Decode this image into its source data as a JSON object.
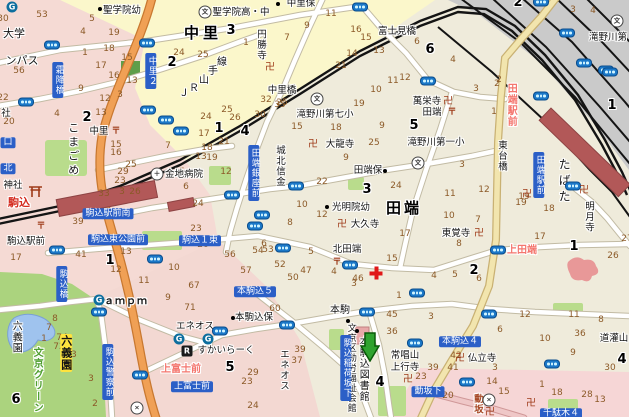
{
  "map_title": "駒込・田端周辺地図",
  "colors": {
    "badge_blue": "#2B5FC7",
    "road_orange": "#F0A055",
    "road_yellow": "#F2E5AE",
    "rail_black": "#111111",
    "station_red": "#B25858",
    "park_green": "#ABD37E",
    "pond_blue": "#9FC3EE",
    "block_yellow": "#FBF7CB",
    "block_pink": "#F5DAD4",
    "block_beige": "#EFEBDB",
    "yard_gray": "#CACACA",
    "lot_number_brown": "#8C5A28",
    "marker_green": "#2FA32F",
    "intersection_pink": "#F4766E"
  },
  "marker": {
    "x": 360,
    "y": 332,
    "points_to": "本駒込図書館"
  },
  "labels": [
    {
      "t": "聖学院幼",
      "x": 122,
      "y": 11
    },
    {
      "t": "中里保",
      "x": 301,
      "y": 4
    },
    {
      "t": "聖学院高・中",
      "x": 241,
      "y": 13
    },
    {
      "t": "中里",
      "x": 203,
      "y": 34,
      "s": "big",
      "fs": 15,
      "ls": 4
    },
    {
      "t": "円勝寺",
      "x": 260,
      "y": 45,
      "v": 1
    },
    {
      "t": "富士見橋",
      "x": 397,
      "y": 32
    },
    {
      "t": "中里橋",
      "x": 282,
      "y": 91
    },
    {
      "t": "Ｊ",
      "x": 184,
      "y": 94,
      "fs": 10
    },
    {
      "t": "Ｒ",
      "x": 194,
      "y": 89,
      "fs": 10
    },
    {
      "t": "山",
      "x": 204,
      "y": 81,
      "fs": 10
    },
    {
      "t": "手",
      "x": 213,
      "y": 72,
      "fs": 10
    },
    {
      "t": "線",
      "x": 222,
      "y": 63,
      "fs": 10
    },
    {
      "t": "こまごめ",
      "x": 73,
      "y": 150,
      "v": 1,
      "fs": 11,
      "ls": 3
    },
    {
      "t": "中里",
      "x": 99,
      "y": 132
    },
    {
      "t": "金地病院",
      "x": 184,
      "y": 175
    },
    {
      "t": "駒込",
      "x": 19,
      "y": 203,
      "s": "red"
    },
    {
      "t": "駒込駅前",
      "x": 26,
      "y": 242
    },
    {
      "t": "城北信金",
      "x": 279,
      "y": 166,
      "v": 1
    },
    {
      "t": "滝野川第七小",
      "x": 325,
      "y": 115
    },
    {
      "t": "大龍寺",
      "x": 340,
      "y": 145
    },
    {
      "t": "田端保",
      "x": 368,
      "y": 171
    },
    {
      "t": "光明院幼",
      "x": 351,
      "y": 208
    },
    {
      "t": "大久寺",
      "x": 365,
      "y": 225
    },
    {
      "t": "北田端",
      "x": 347,
      "y": 250
    },
    {
      "t": "田端",
      "x": 404,
      "y": 209,
      "s": "big",
      "fs": 15,
      "ls": 3
    },
    {
      "t": "萬栄寺",
      "x": 427,
      "y": 102
    },
    {
      "t": "田端",
      "x": 432,
      "y": 113
    },
    {
      "t": "滝野川第一小",
      "x": 436,
      "y": 143
    },
    {
      "t": "滝野川第",
      "x": 608,
      "y": 38
    },
    {
      "t": "東台橋",
      "x": 501,
      "y": 156,
      "v": 1
    },
    {
      "t": "東覚寺",
      "x": 456,
      "y": 234
    },
    {
      "t": "明月寺",
      "x": 588,
      "y": 217,
      "v": 1
    },
    {
      "t": "上田端",
      "x": 522,
      "y": 251,
      "s": "pink"
    },
    {
      "t": "田端駅前",
      "x": 510,
      "y": 105,
      "s": "pink",
      "v": 1
    },
    {
      "t": "たばた",
      "x": 564,
      "y": 182,
      "v": 1,
      "fs": 12,
      "ls": 4
    },
    {
      "t": "仏立寺",
      "x": 482,
      "y": 359
    },
    {
      "t": "道灌山",
      "x": 614,
      "y": 339
    },
    {
      "t": "常唱山",
      "x": 405,
      "y": 356
    },
    {
      "t": "上行寺",
      "x": 405,
      "y": 368
    },
    {
      "t": "エネオス",
      "x": 195,
      "y": 327
    },
    {
      "t": "エネオス",
      "x": 283,
      "y": 370,
      "v": 1
    },
    {
      "t": "すかいらーく",
      "x": 226,
      "y": 351
    },
    {
      "t": "ａｍｐｍ",
      "x": 126,
      "y": 302,
      "s": "store",
      "fs": 10
    },
    {
      "t": "本駒込保",
      "x": 254,
      "y": 318
    },
    {
      "t": "文京区勤労福祉会館",
      "x": 350,
      "y": 368,
      "v": 1,
      "fs": 9
    },
    {
      "t": "本駒込図書館",
      "x": 362,
      "y": 369,
      "v": 1,
      "fs": 10
    },
    {
      "t": "本駒",
      "x": 340,
      "y": 311,
      "fs": 10
    },
    {
      "t": "六義園",
      "x": 15,
      "y": 337,
      "v": 1,
      "fs": 10
    },
    {
      "t": "六義園",
      "x": 66,
      "y": 353,
      "v": 1,
      "s": "hl",
      "fs": 11
    },
    {
      "t": "文京グリーン",
      "x": 36,
      "y": 380,
      "v": 1,
      "s": "green",
      "fs": 10
    },
    {
      "t": "上富士前",
      "x": 181,
      "y": 370,
      "s": "pink"
    },
    {
      "t": "動坂",
      "x": 477,
      "y": 404,
      "v": 1,
      "s": "dred"
    },
    {
      "t": "大学",
      "x": 14,
      "y": 34,
      "fs": 11
    },
    {
      "t": "ンパス",
      "x": 22,
      "y": 61,
      "fs": 11
    },
    {
      "t": "社",
      "x": 6,
      "y": 114
    },
    {
      "t": "神社",
      "x": 13,
      "y": 186
    }
  ],
  "big_numbers": [
    {
      "t": "3",
      "x": 231,
      "y": 31
    },
    {
      "t": "2",
      "x": 172,
      "y": 63
    },
    {
      "t": "2",
      "x": 87,
      "y": 118
    },
    {
      "t": "1",
      "x": 219,
      "y": 129
    },
    {
      "t": "4",
      "x": 245,
      "y": 132
    },
    {
      "t": "5",
      "x": 414,
      "y": 126
    },
    {
      "t": "6",
      "x": 430,
      "y": 50
    },
    {
      "t": "3",
      "x": 367,
      "y": 190
    },
    {
      "t": "1",
      "x": 110,
      "y": 261
    },
    {
      "t": "2",
      "x": 474,
      "y": 271
    },
    {
      "t": "1",
      "x": 574,
      "y": 247
    },
    {
      "t": "1",
      "x": 612,
      "y": 106
    },
    {
      "t": "6",
      "x": 16,
      "y": 400
    },
    {
      "t": "5",
      "x": 230,
      "y": 368
    },
    {
      "t": "4",
      "x": 380,
      "y": 383
    },
    {
      "t": "4",
      "x": 622,
      "y": 360
    },
    {
      "t": "2",
      "x": 518,
      "y": 3
    }
  ],
  "bus_stop_badges": [
    {
      "t": "霜降橋",
      "x": 58,
      "y": 80,
      "v": 1
    },
    {
      "t": "中里２",
      "x": 151,
      "y": 71,
      "v": 1
    },
    {
      "t": "田端銀座前",
      "x": 254,
      "y": 173,
      "v": 1
    },
    {
      "t": "田端駅前",
      "x": 539,
      "y": 175,
      "v": 1
    },
    {
      "t": "駒込駅前南",
      "x": 108,
      "y": 214
    },
    {
      "t": "駒込東公園前",
      "x": 118,
      "y": 240
    },
    {
      "t": "駒込１東",
      "x": 200,
      "y": 241
    },
    {
      "t": "駒込橋",
      "x": 62,
      "y": 284,
      "v": 1
    },
    {
      "t": "本駒込５",
      "x": 255,
      "y": 292
    },
    {
      "t": "本駒込４",
      "x": 460,
      "y": 342
    },
    {
      "t": "上富士前",
      "x": 192,
      "y": 387
    },
    {
      "t": "駒込警察前",
      "x": 108,
      "y": 372,
      "v": 1
    },
    {
      "t": "駒込稲荷坂下",
      "x": 346,
      "y": 368,
      "v": 1
    },
    {
      "t": "動坂下",
      "x": 428,
      "y": 392
    },
    {
      "t": "千駄木４",
      "x": 561,
      "y": 414
    },
    {
      "t": "口",
      "x": 8,
      "y": 143
    },
    {
      "t": "北",
      "x": 8,
      "y": 169
    }
  ],
  "icons": [
    [
      "signal",
      52,
      45
    ],
    [
      "signal",
      147,
      43
    ],
    [
      "signal",
      360,
      7
    ],
    [
      "signal",
      541,
      2
    ],
    [
      "signal",
      567,
      33
    ],
    [
      "signal",
      584,
      63
    ],
    [
      "signal",
      606,
      70
    ],
    [
      "signal",
      610,
      72
    ],
    [
      "signal",
      428,
      81
    ],
    [
      "signal",
      541,
      96
    ],
    [
      "signal",
      573,
      186
    ],
    [
      "signal",
      26,
      102
    ],
    [
      "signal",
      148,
      110
    ],
    [
      "signal",
      166,
      120
    ],
    [
      "signal",
      181,
      131
    ],
    [
      "signal",
      296,
      186
    ],
    [
      "signal",
      232,
      195
    ],
    [
      "signal",
      262,
      215
    ],
    [
      "signal",
      255,
      226
    ],
    [
      "signal",
      283,
      248
    ],
    [
      "signal",
      57,
      250
    ],
    [
      "signal",
      155,
      259
    ],
    [
      "signal",
      350,
      265
    ],
    [
      "signal",
      498,
      250
    ],
    [
      "signal",
      417,
      293
    ],
    [
      "signal",
      489,
      314
    ],
    [
      "signal",
      367,
      312
    ],
    [
      "signal",
      415,
      343
    ],
    [
      "signal",
      552,
      364
    ],
    [
      "signal",
      467,
      382
    ],
    [
      "signal",
      99,
      312
    ],
    [
      "signal",
      140,
      375
    ],
    [
      "signal",
      287,
      325
    ],
    [
      "signal",
      220,
      331
    ],
    [
      "manji",
      270,
      68
    ],
    [
      "manji",
      584,
      191
    ],
    [
      "manji",
      408,
      380
    ],
    [
      "manji",
      531,
      404
    ],
    [
      "manji",
      490,
      413
    ],
    [
      "manji",
      527,
      195
    ],
    [
      "manji",
      313,
      145
    ],
    [
      "manji",
      342,
      225
    ],
    [
      "manji",
      460,
      359
    ],
    [
      "manji",
      448,
      102
    ],
    [
      "manji",
      479,
      234
    ],
    [
      "post",
      41,
      227
    ],
    [
      "post",
      116,
      132
    ],
    [
      "post",
      452,
      113
    ],
    [
      "post",
      337,
      263
    ],
    [
      "school",
      317,
      99
    ],
    [
      "school",
      418,
      163
    ],
    [
      "school",
      205,
      12
    ],
    [
      "school",
      617,
      21
    ],
    [
      "police",
      137,
      408
    ],
    [
      "police",
      489,
      400
    ],
    [
      "hospital",
      157,
      174
    ],
    [
      "redcross",
      376,
      273
    ],
    [
      "torii",
      29,
      186
    ],
    [
      "gas",
      12,
      7
    ],
    [
      "gas",
      99,
      300
    ],
    [
      "gas",
      179,
      339
    ],
    [
      "gas",
      208,
      339
    ],
    [
      "restaurant",
      187,
      351
    ],
    [
      "dot",
      100,
      9
    ],
    [
      "dot",
      278,
      4
    ],
    [
      "dot",
      327,
      207
    ],
    [
      "dot",
      385,
      171
    ],
    [
      "dot",
      233,
      318
    ],
    [
      "dot",
      348,
      321
    ],
    [
      "dot",
      357,
      331
    ]
  ],
  "lot_numbers": [
    [
      53,
      42,
      15
    ],
    [
      30,
      3,
      19
    ],
    [
      5,
      92,
      19
    ],
    [
      4,
      83,
      32
    ],
    [
      19,
      114,
      33
    ],
    [
      21,
      146,
      44
    ],
    [
      24,
      179,
      53
    ],
    [
      25,
      203,
      55
    ],
    [
      1,
      85,
      53
    ],
    [
      18,
      109,
      49
    ],
    [
      15,
      127,
      58
    ],
    [
      17,
      101,
      66
    ],
    [
      16,
      114,
      76
    ],
    [
      13,
      132,
      81
    ],
    [
      9,
      81,
      89
    ],
    [
      12,
      105,
      99
    ],
    [
      3,
      120,
      95
    ],
    [
      56,
      19,
      71
    ],
    [
      22,
      3,
      98
    ],
    [
      11,
      331,
      14
    ],
    [
      9,
      307,
      26
    ],
    [
      16,
      356,
      30
    ],
    [
      15,
      366,
      38
    ],
    [
      13,
      379,
      51
    ],
    [
      14,
      352,
      54
    ],
    [
      21,
      341,
      66
    ],
    [
      12,
      405,
      78
    ],
    [
      11,
      393,
      81
    ],
    [
      10,
      376,
      90
    ],
    [
      7,
      287,
      38
    ],
    [
      1,
      246,
      43
    ],
    [
      32,
      266,
      100
    ],
    [
      25,
      282,
      103
    ],
    [
      6,
      417,
      42
    ],
    [
      4,
      453,
      60
    ],
    [
      3,
      476,
      89
    ],
    [
      2,
      499,
      80
    ],
    [
      3,
      573,
      10
    ],
    [
      4,
      593,
      11
    ],
    [
      4,
      57,
      114
    ],
    [
      20,
      9,
      122
    ],
    [
      13,
      101,
      113
    ],
    [
      15,
      116,
      145
    ],
    [
      16,
      116,
      153
    ],
    [
      25,
      131,
      165
    ],
    [
      29,
      123,
      172
    ],
    [
      23,
      120,
      181
    ],
    [
      33,
      104,
      194
    ],
    [
      3,
      122,
      192
    ],
    [
      26,
      135,
      192
    ],
    [
      5,
      182,
      172
    ],
    [
      6,
      186,
      187
    ],
    [
      17,
      204,
      134
    ],
    [
      13,
      201,
      157
    ],
    [
      7,
      168,
      146
    ],
    [
      35,
      280,
      105
    ],
    [
      30,
      260,
      115
    ],
    [
      25,
      227,
      110
    ],
    [
      26,
      235,
      118
    ],
    [
      24,
      206,
      117
    ],
    [
      15,
      297,
      127
    ],
    [
      18,
      336,
      128
    ],
    [
      19,
      359,
      104
    ],
    [
      9,
      346,
      158
    ],
    [
      22,
      322,
      182
    ],
    [
      25,
      374,
      143
    ],
    [
      24,
      396,
      186
    ],
    [
      9,
      382,
      126
    ],
    [
      12,
      226,
      172
    ],
    [
      19,
      212,
      158
    ],
    [
      18,
      207,
      148
    ],
    [
      21,
      224,
      142
    ],
    [
      3,
      462,
      165
    ],
    [
      11,
      450,
      194
    ],
    [
      12,
      484,
      190
    ],
    [
      19,
      524,
      197
    ],
    [
      1,
      494,
      112
    ],
    [
      2,
      497,
      84
    ],
    [
      17,
      16,
      258
    ],
    [
      39,
      78,
      222
    ],
    [
      41,
      81,
      255
    ],
    [
      24,
      198,
      204
    ],
    [
      23,
      196,
      229
    ],
    [
      20,
      203,
      245
    ],
    [
      13,
      126,
      252
    ],
    [
      12,
      116,
      270
    ],
    [
      11,
      144,
      281
    ],
    [
      10,
      174,
      268
    ],
    [
      9,
      168,
      298
    ],
    [
      67,
      194,
      286
    ],
    [
      10,
      302,
      205
    ],
    [
      12,
      322,
      215
    ],
    [
      8,
      290,
      223
    ],
    [
      5,
      311,
      252
    ],
    [
      4,
      334,
      272
    ],
    [
      3,
      354,
      284
    ],
    [
      46,
      358,
      279
    ],
    [
      47,
      306,
      271
    ],
    [
      50,
      293,
      278
    ],
    [
      52,
      280,
      265
    ],
    [
      53,
      268,
      250
    ],
    [
      54,
      258,
      251
    ],
    [
      56,
      230,
      255
    ],
    [
      57,
      246,
      271
    ],
    [
      17,
      405,
      234
    ],
    [
      15,
      392,
      259
    ],
    [
      1,
      399,
      296
    ],
    [
      6,
      264,
      244
    ],
    [
      19,
      521,
      203
    ],
    [
      18,
      549,
      209
    ],
    [
      17,
      540,
      237
    ],
    [
      10,
      449,
      216
    ],
    [
      7,
      478,
      220
    ],
    [
      8,
      459,
      244
    ],
    [
      4,
      434,
      276
    ],
    [
      5,
      455,
      275
    ],
    [
      6,
      479,
      279
    ],
    [
      26,
      613,
      256
    ],
    [
      27,
      627,
      239
    ],
    [
      7,
      49,
      328
    ],
    [
      8,
      55,
      319
    ],
    [
      1,
      44,
      339
    ],
    [
      74,
      62,
      338
    ],
    [
      72,
      59,
      347
    ],
    [
      73,
      71,
      355
    ],
    [
      3,
      91,
      379
    ],
    [
      2,
      95,
      404
    ],
    [
      71,
      190,
      308
    ],
    [
      60,
      275,
      309
    ],
    [
      39,
      300,
      350
    ],
    [
      37,
      297,
      361
    ],
    [
      29,
      253,
      373
    ],
    [
      23,
      247,
      382
    ],
    [
      24,
      253,
      406
    ],
    [
      45,
      392,
      315
    ],
    [
      36,
      392,
      332
    ],
    [
      3,
      431,
      317
    ],
    [
      12,
      525,
      315
    ],
    [
      11,
      574,
      315
    ],
    [
      8,
      601,
      320
    ],
    [
      10,
      545,
      339
    ],
    [
      6,
      500,
      330
    ],
    [
      9,
      573,
      353
    ],
    [
      42,
      456,
      356
    ],
    [
      41,
      453,
      368
    ],
    [
      39,
      433,
      368
    ],
    [
      23,
      421,
      377
    ],
    [
      20,
      448,
      396
    ],
    [
      14,
      492,
      382
    ],
    [
      7,
      470,
      382
    ],
    [
      15,
      504,
      392
    ],
    [
      3,
      495,
      368
    ],
    [
      1,
      542,
      385
    ],
    [
      18,
      557,
      393
    ],
    [
      28,
      587,
      395
    ],
    [
      13,
      600,
      400
    ],
    [
      30,
      610,
      368
    ],
    [
      36,
      580,
      334
    ]
  ]
}
